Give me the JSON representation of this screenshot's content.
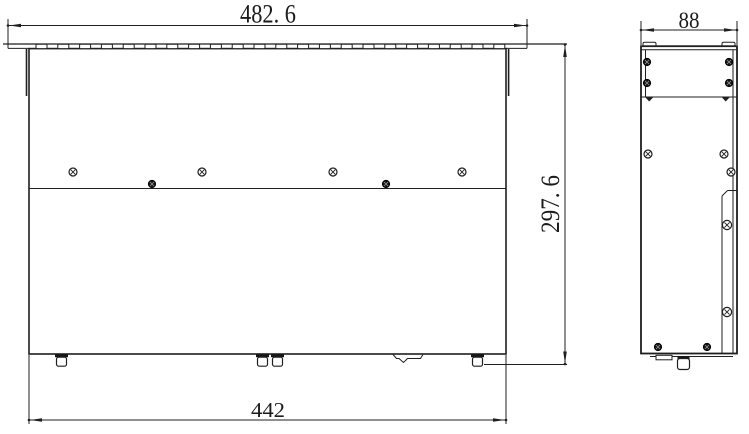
{
  "drawing": {
    "kind": "engineering-dimension-drawing",
    "line_color": "#1f1f1f",
    "background": "#ffffff"
  },
  "dimensions": {
    "flange_width_label": "482. 6",
    "overall_height_label": "297. 6",
    "body_width_label": "442",
    "depth_label": "88"
  }
}
